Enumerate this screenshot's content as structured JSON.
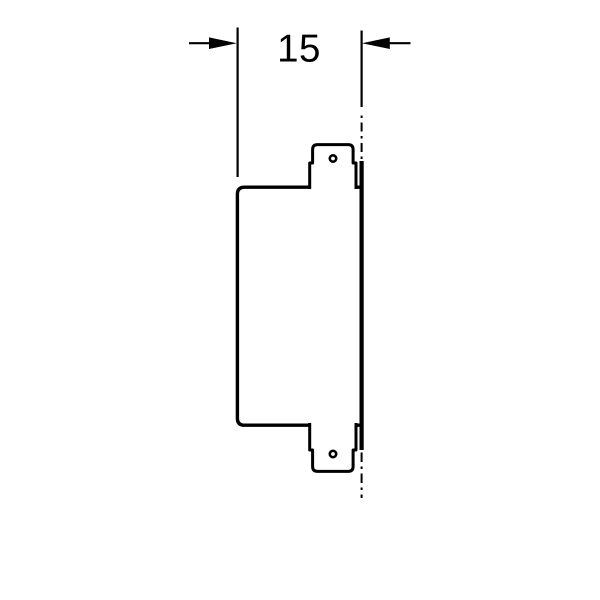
{
  "diagram": {
    "type": "technical-drawing-side-view",
    "dimension": {
      "label": "15"
    },
    "colors": {
      "line": "#000000",
      "background": "#ffffff"
    }
  }
}
